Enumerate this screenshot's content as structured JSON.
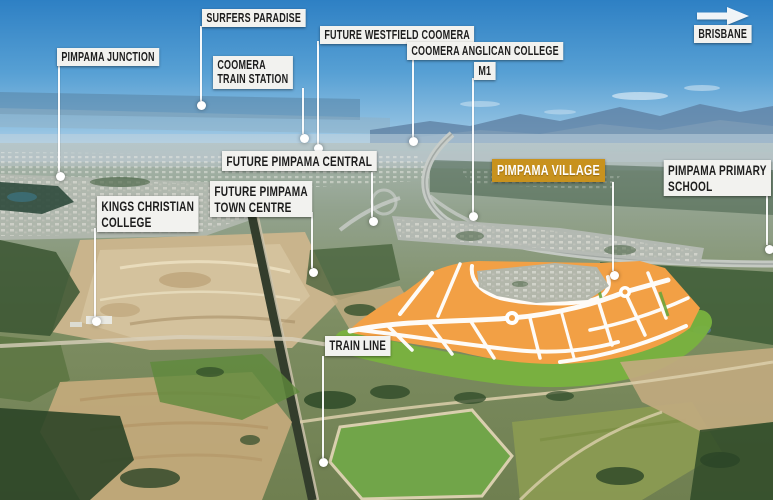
{
  "colors": {
    "label_bg": "#F2F2EF",
    "label_text": "#1D1D1D",
    "highlight_bg": "#C8921E",
    "highlight_text": "#FFFFFF",
    "leader_white": "#FFFFFF",
    "estate_orange": "#F2A045",
    "estate_green": "#79B23E"
  },
  "annotations": {
    "surfers_paradise": "SURFERS PARADISE",
    "future_westfield_coomera": "FUTURE WESTFIELD COOMERA",
    "coomera_anglican_college": "COOMERA ANGLICAN COLLEGE",
    "m1": "M1",
    "brisbane": "BRISBANE",
    "pimpama_junction": "PIMPAMA JUNCTION",
    "coomera_train_station": "COOMERA\nTRAIN STATION",
    "future_pimpama_central": "FUTURE PIMPAMA CENTRAL",
    "future_pimpama_town_centre": "FUTURE PIMPAMA\nTOWN CENTRE",
    "kings_christian_college": "KINGS CHRISTIAN\nCOLLEGE",
    "pimpama_village": "PIMPAMA VILLAGE",
    "pimpama_primary_school": "PIMPAMA PRIMARY\nSCHOOL",
    "train_line": "TRAIN LINE"
  }
}
